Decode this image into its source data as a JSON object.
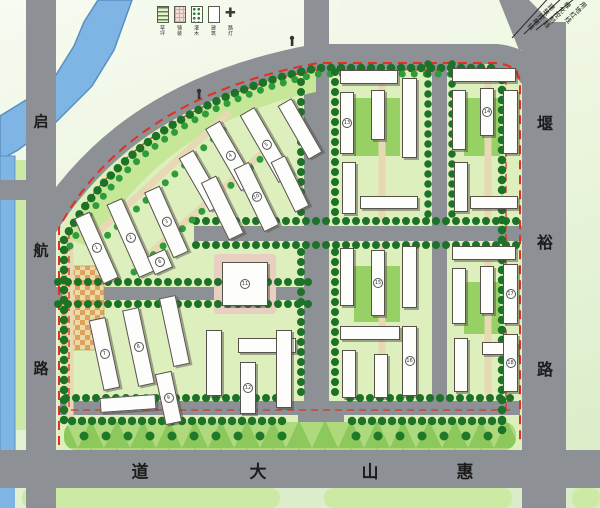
{
  "title": "residential district master plan",
  "legend": {
    "items": [
      {
        "name": "lawn",
        "label": "草坪"
      },
      {
        "name": "paving",
        "label": "铺装"
      },
      {
        "name": "shrub",
        "label": "灌木"
      },
      {
        "name": "building",
        "label": "建筑"
      },
      {
        "name": "lamp",
        "label": "路灯"
      }
    ]
  },
  "annotations": {
    "control_lines": [
      {
        "name": "land-use-red-line",
        "label": "用地红线"
      },
      {
        "name": "greening-control-line",
        "label": "绿化控制线"
      },
      {
        "name": "building-control-line",
        "label": "建筑控制线"
      }
    ]
  },
  "roads": {
    "left": {
      "label": "启航路",
      "chars": [
        {
          "c": "启",
          "x": 41,
          "y": 121
        },
        {
          "c": "航",
          "x": 41,
          "y": 250
        },
        {
          "c": "路",
          "x": 41,
          "y": 368
        }
      ]
    },
    "right": {
      "label": "堰裕路",
      "chars": [
        {
          "c": "堰",
          "x": 545,
          "y": 122
        },
        {
          "c": "裕",
          "x": 545,
          "y": 241
        },
        {
          "c": "路",
          "x": 545,
          "y": 368
        }
      ]
    },
    "bottom": {
      "label": "惠山大道",
      "chars": [
        {
          "c": "道",
          "x": 140,
          "y": 470
        },
        {
          "c": "大",
          "x": 258,
          "y": 470
        },
        {
          "c": "山",
          "x": 370,
          "y": 470
        },
        {
          "c": "惠",
          "x": 465,
          "y": 470
        }
      ]
    }
  },
  "colors": {
    "road": "#8d9094",
    "river": "#7fb5e5",
    "site_base": "#dcefbc",
    "lawn": "#97d065",
    "tree": "#1c7226",
    "red_line": "#e2301f",
    "path_tan": "#e7d9b4",
    "plaza_orange": "#dca35f",
    "building_fill": "#fdfdfc"
  },
  "site": {
    "buildings": [
      {
        "x": 88,
        "y": 212,
        "w": 17,
        "h": 72,
        "rot": -24,
        "n": "1"
      },
      {
        "x": 122,
        "y": 198,
        "w": 17,
        "h": 80,
        "rot": -24,
        "n": "2"
      },
      {
        "x": 158,
        "y": 186,
        "w": 17,
        "h": 72,
        "rot": -24,
        "n": "3"
      },
      {
        "x": 193,
        "y": 150,
        "w": 17,
        "h": 62,
        "rot": -30
      },
      {
        "x": 222,
        "y": 120,
        "w": 17,
        "h": 72,
        "rot": -30,
        "n": "4"
      },
      {
        "x": 258,
        "y": 106,
        "w": 17,
        "h": 78,
        "rot": -30,
        "n": "5"
      },
      {
        "x": 292,
        "y": 98,
        "w": 16,
        "h": 62,
        "rot": -30
      },
      {
        "x": 150,
        "y": 252,
        "w": 20,
        "h": 20,
        "rot": -24,
        "n": "6"
      },
      {
        "x": 96,
        "y": 318,
        "w": 17,
        "h": 72,
        "rot": -12,
        "n": "7"
      },
      {
        "x": 130,
        "y": 308,
        "w": 17,
        "h": 78,
        "rot": -12,
        "n": "8"
      },
      {
        "x": 166,
        "y": 296,
        "w": 17,
        "h": 70,
        "rot": -12
      },
      {
        "x": 100,
        "y": 396,
        "w": 56,
        "h": 15,
        "rot": -4
      },
      {
        "x": 160,
        "y": 372,
        "w": 17,
        "h": 52,
        "rot": -12,
        "n": "9"
      },
      {
        "x": 214,
        "y": 176,
        "w": 17,
        "h": 64,
        "rot": -26
      },
      {
        "x": 248,
        "y": 162,
        "w": 17,
        "h": 70,
        "rot": -26,
        "n": "10"
      },
      {
        "x": 282,
        "y": 156,
        "w": 16,
        "h": 56,
        "rot": -26
      },
      {
        "x": 222,
        "y": 262,
        "w": 46,
        "h": 44,
        "rot": 0,
        "n": "11"
      },
      {
        "x": 206,
        "y": 330,
        "w": 16,
        "h": 66,
        "rot": 0
      },
      {
        "x": 238,
        "y": 338,
        "w": 58,
        "h": 15,
        "rot": 0
      },
      {
        "x": 240,
        "y": 362,
        "w": 16,
        "h": 52,
        "rot": 0,
        "n": "12"
      },
      {
        "x": 276,
        "y": 330,
        "w": 16,
        "h": 78,
        "rot": 0
      },
      {
        "x": 340,
        "y": 70,
        "w": 58,
        "h": 14,
        "rot": 0
      },
      {
        "x": 340,
        "y": 92,
        "w": 14,
        "h": 62,
        "rot": 0,
        "n": "13"
      },
      {
        "x": 371,
        "y": 90,
        "w": 14,
        "h": 50,
        "rot": 0
      },
      {
        "x": 402,
        "y": 78,
        "w": 15,
        "h": 80,
        "rot": 0
      },
      {
        "x": 342,
        "y": 162,
        "w": 14,
        "h": 52,
        "rot": 0
      },
      {
        "x": 360,
        "y": 196,
        "w": 58,
        "h": 13,
        "rot": 0
      },
      {
        "x": 452,
        "y": 68,
        "w": 64,
        "h": 14,
        "rot": 0
      },
      {
        "x": 452,
        "y": 90,
        "w": 14,
        "h": 60,
        "rot": 0
      },
      {
        "x": 480,
        "y": 88,
        "w": 14,
        "h": 48,
        "rot": 0,
        "n": "14"
      },
      {
        "x": 503,
        "y": 90,
        "w": 15,
        "h": 64,
        "rot": 0
      },
      {
        "x": 454,
        "y": 162,
        "w": 14,
        "h": 50,
        "rot": 0
      },
      {
        "x": 470,
        "y": 196,
        "w": 48,
        "h": 13,
        "rot": 0
      },
      {
        "x": 340,
        "y": 248,
        "w": 14,
        "h": 58,
        "rot": 0
      },
      {
        "x": 371,
        "y": 250,
        "w": 14,
        "h": 66,
        "rot": 0,
        "n": "15"
      },
      {
        "x": 402,
        "y": 246,
        "w": 15,
        "h": 62,
        "rot": 0
      },
      {
        "x": 340,
        "y": 326,
        "w": 60,
        "h": 14,
        "rot": 0
      },
      {
        "x": 342,
        "y": 350,
        "w": 14,
        "h": 48,
        "rot": 0
      },
      {
        "x": 374,
        "y": 354,
        "w": 14,
        "h": 44,
        "rot": 0
      },
      {
        "x": 402,
        "y": 326,
        "w": 15,
        "h": 70,
        "rot": 0,
        "n": "16"
      },
      {
        "x": 452,
        "y": 246,
        "w": 64,
        "h": 14,
        "rot": 0
      },
      {
        "x": 452,
        "y": 268,
        "w": 14,
        "h": 56,
        "rot": 0
      },
      {
        "x": 480,
        "y": 266,
        "w": 14,
        "h": 48,
        "rot": 0
      },
      {
        "x": 503,
        "y": 264,
        "w": 15,
        "h": 60,
        "rot": 0,
        "n": "17"
      },
      {
        "x": 454,
        "y": 338,
        "w": 14,
        "h": 54,
        "rot": 0
      },
      {
        "x": 482,
        "y": 342,
        "w": 36,
        "h": 13,
        "rot": 0
      },
      {
        "x": 503,
        "y": 334,
        "w": 15,
        "h": 58,
        "rot": 0,
        "n": "18"
      }
    ]
  }
}
